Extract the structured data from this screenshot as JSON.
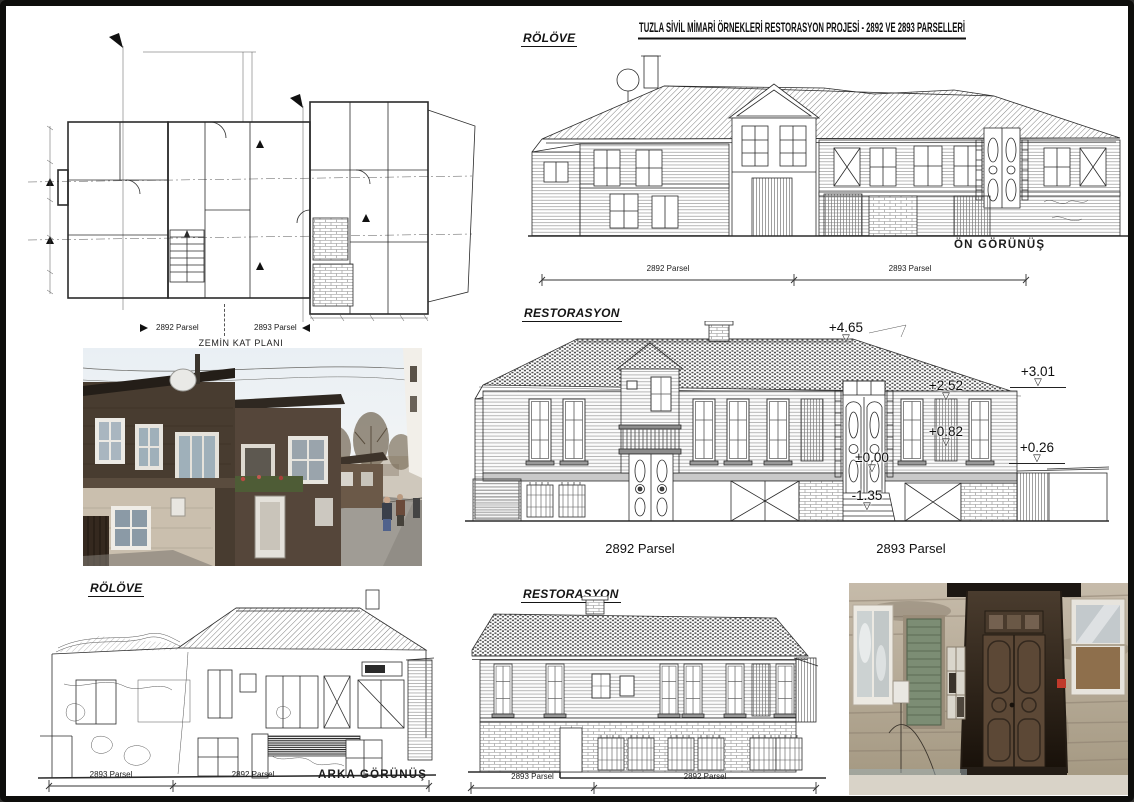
{
  "sheet": {
    "title": "TUZLA SİVİL MİMARİ ÖRNEKLERİ RESTORASYON PROJESİ - 2892 VE 2893 PARSELLERİ"
  },
  "floor_plan": {
    "caption": "ZEMİN KAT PLANI",
    "parsel_left": "2892 Parsel",
    "parsel_right": "2893 Parsel"
  },
  "front_elevation_survey": {
    "heading": "RÖLÖVE",
    "view_label": "ÖN GÖRÜNÜŞ",
    "parsel_left": "2892 Parsel",
    "parsel_right": "2893 Parsel"
  },
  "front_elevation_restoration": {
    "heading": "RESTORASYON",
    "parsel_left": "2892 Parsel",
    "parsel_right": "2893 Parsel",
    "levels": [
      "+4.65",
      "+3.01",
      "+2.52",
      "+0.82",
      "+0.26",
      "±0.00",
      "-1.35"
    ]
  },
  "rear_elevation_survey": {
    "heading": "RÖLÖVE",
    "view_label": "ARKA GÖRÜNÜŞ",
    "parsel_left": "2893 Parsel",
    "parsel_right": "2892 Parsel"
  },
  "rear_elevation_restoration": {
    "heading": "RESTORASYON",
    "parsel_left": "2893 Parsel",
    "parsel_right": "2892 Parsel"
  },
  "photos": {
    "street_photo_alt": "Street view of the historic timber houses",
    "door_photo_alt": "Weathered wooden entrance door of the house"
  },
  "icons": {
    "level_triangle": "▽"
  },
  "colors": {
    "ink": "#1a1a1a",
    "drawing_gray": "#555555",
    "sheet": "#ffffff"
  }
}
